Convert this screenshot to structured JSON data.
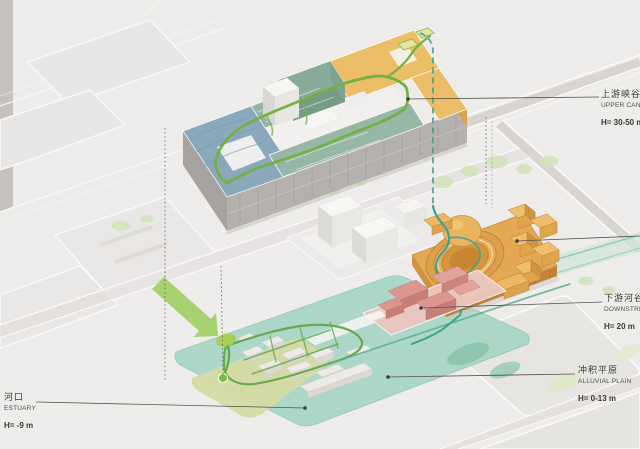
{
  "diagram": {
    "type": "axonometric-site-strategy-diagram",
    "labels": [
      {
        "id": "upper-canyon",
        "zh": "上游峡谷",
        "en": "UPPER CANYON",
        "elevation": "H= 30-50 m"
      },
      {
        "id": "downstream-valley",
        "zh": "下游河谷",
        "en": "DOWNSTREAM",
        "elevation": "H= 20 m"
      },
      {
        "id": "alluvial-plain",
        "zh": "冲积平原",
        "en": "ALLUVIAL PLAIN",
        "elevation": "H= 0-13 m"
      },
      {
        "id": "estuary",
        "zh": "河口",
        "en": "ESTUARY",
        "elevation": "H= -9 m"
      }
    ],
    "colors": {
      "background": "#edecea",
      "upper_building_blue": "#87a6b9",
      "upper_building_teal": "#94b5a4",
      "upper_building_orange": "#eabd66",
      "canyon_building_orange": "#e4a852",
      "downstream_building_pink": "#dd968f",
      "plain_plaza_teal": "#a6d5c5",
      "estuary_green": "#d5dba3",
      "route_green": "#74b045",
      "route_teal": "#3fa28e",
      "flow_arrow_green": "#8cc63f",
      "label_text": "#3b3936"
    }
  }
}
